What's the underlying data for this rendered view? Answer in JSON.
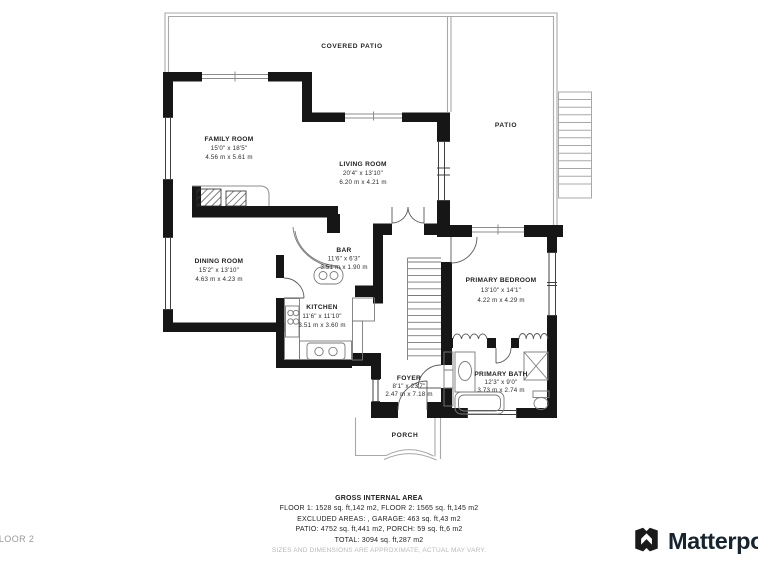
{
  "floorplan": {
    "floor_label": "FLOOR 2",
    "areas": {
      "covered_patio": "COVERED PATIO",
      "patio": "PATIO",
      "porch": "PORCH"
    },
    "rooms": [
      {
        "name": "FAMILY ROOM",
        "dims_ft": "15'0\" x 18'5\"",
        "dims_m": "4.56 m x 5.61 m"
      },
      {
        "name": "LIVING ROOM",
        "dims_ft": "20'4\" x 13'10\"",
        "dims_m": "6.20 m x 4.21 m"
      },
      {
        "name": "DINING ROOM",
        "dims_ft": "15'2\" x 13'10\"",
        "dims_m": "4.63 m x 4.23 m"
      },
      {
        "name": "BAR",
        "dims_ft": "11'6\" x 6'3\"",
        "dims_m": "3.51 m x 1.90 m"
      },
      {
        "name": "KITCHEN",
        "dims_ft": "11'6\" x 11'10\"",
        "dims_m": "3.51 m x 3.60 m"
      },
      {
        "name": "PRIMARY BEDROOM",
        "dims_ft": "13'10\" x 14'1\"",
        "dims_m": "4.22 m x 4.29 m"
      },
      {
        "name": "FOYER",
        "dims_ft": "8'1\" x 23'7\"",
        "dims_m": "2.47 m x 7.18 m"
      },
      {
        "name": "PRIMARY BATH",
        "dims_ft": "12'3\" x 9'0\"",
        "dims_m": "3.73 m x 2.74 m"
      }
    ]
  },
  "footer": {
    "title": "GROSS INTERNAL AREA",
    "lines": [
      "FLOOR 1: 1528 sq. ft,142 m2, FLOOR 2: 1565 sq. ft,145 m2",
      "EXCLUDED AREAS: , GARAGE: 463 sq. ft,43 m2",
      "PATIO: 4752 sq. ft,441 m2, PORCH: 59 sq. ft,6 m2",
      "TOTAL: 3094 sq. ft,287 m2"
    ],
    "disclaimer": "SIZES AND DIMENSIONS ARE APPROXIMATE, ACTUAL MAY VARY."
  },
  "branding": {
    "logo_text": "Matterport"
  },
  "colors": {
    "wall": "#161616",
    "outdoor_outline": "#a8a8a8",
    "fixture": "#6e6e6e",
    "label_text": "#1d1d1d",
    "muted_text": "#b9b9b9",
    "logo_text": "#16242f"
  }
}
